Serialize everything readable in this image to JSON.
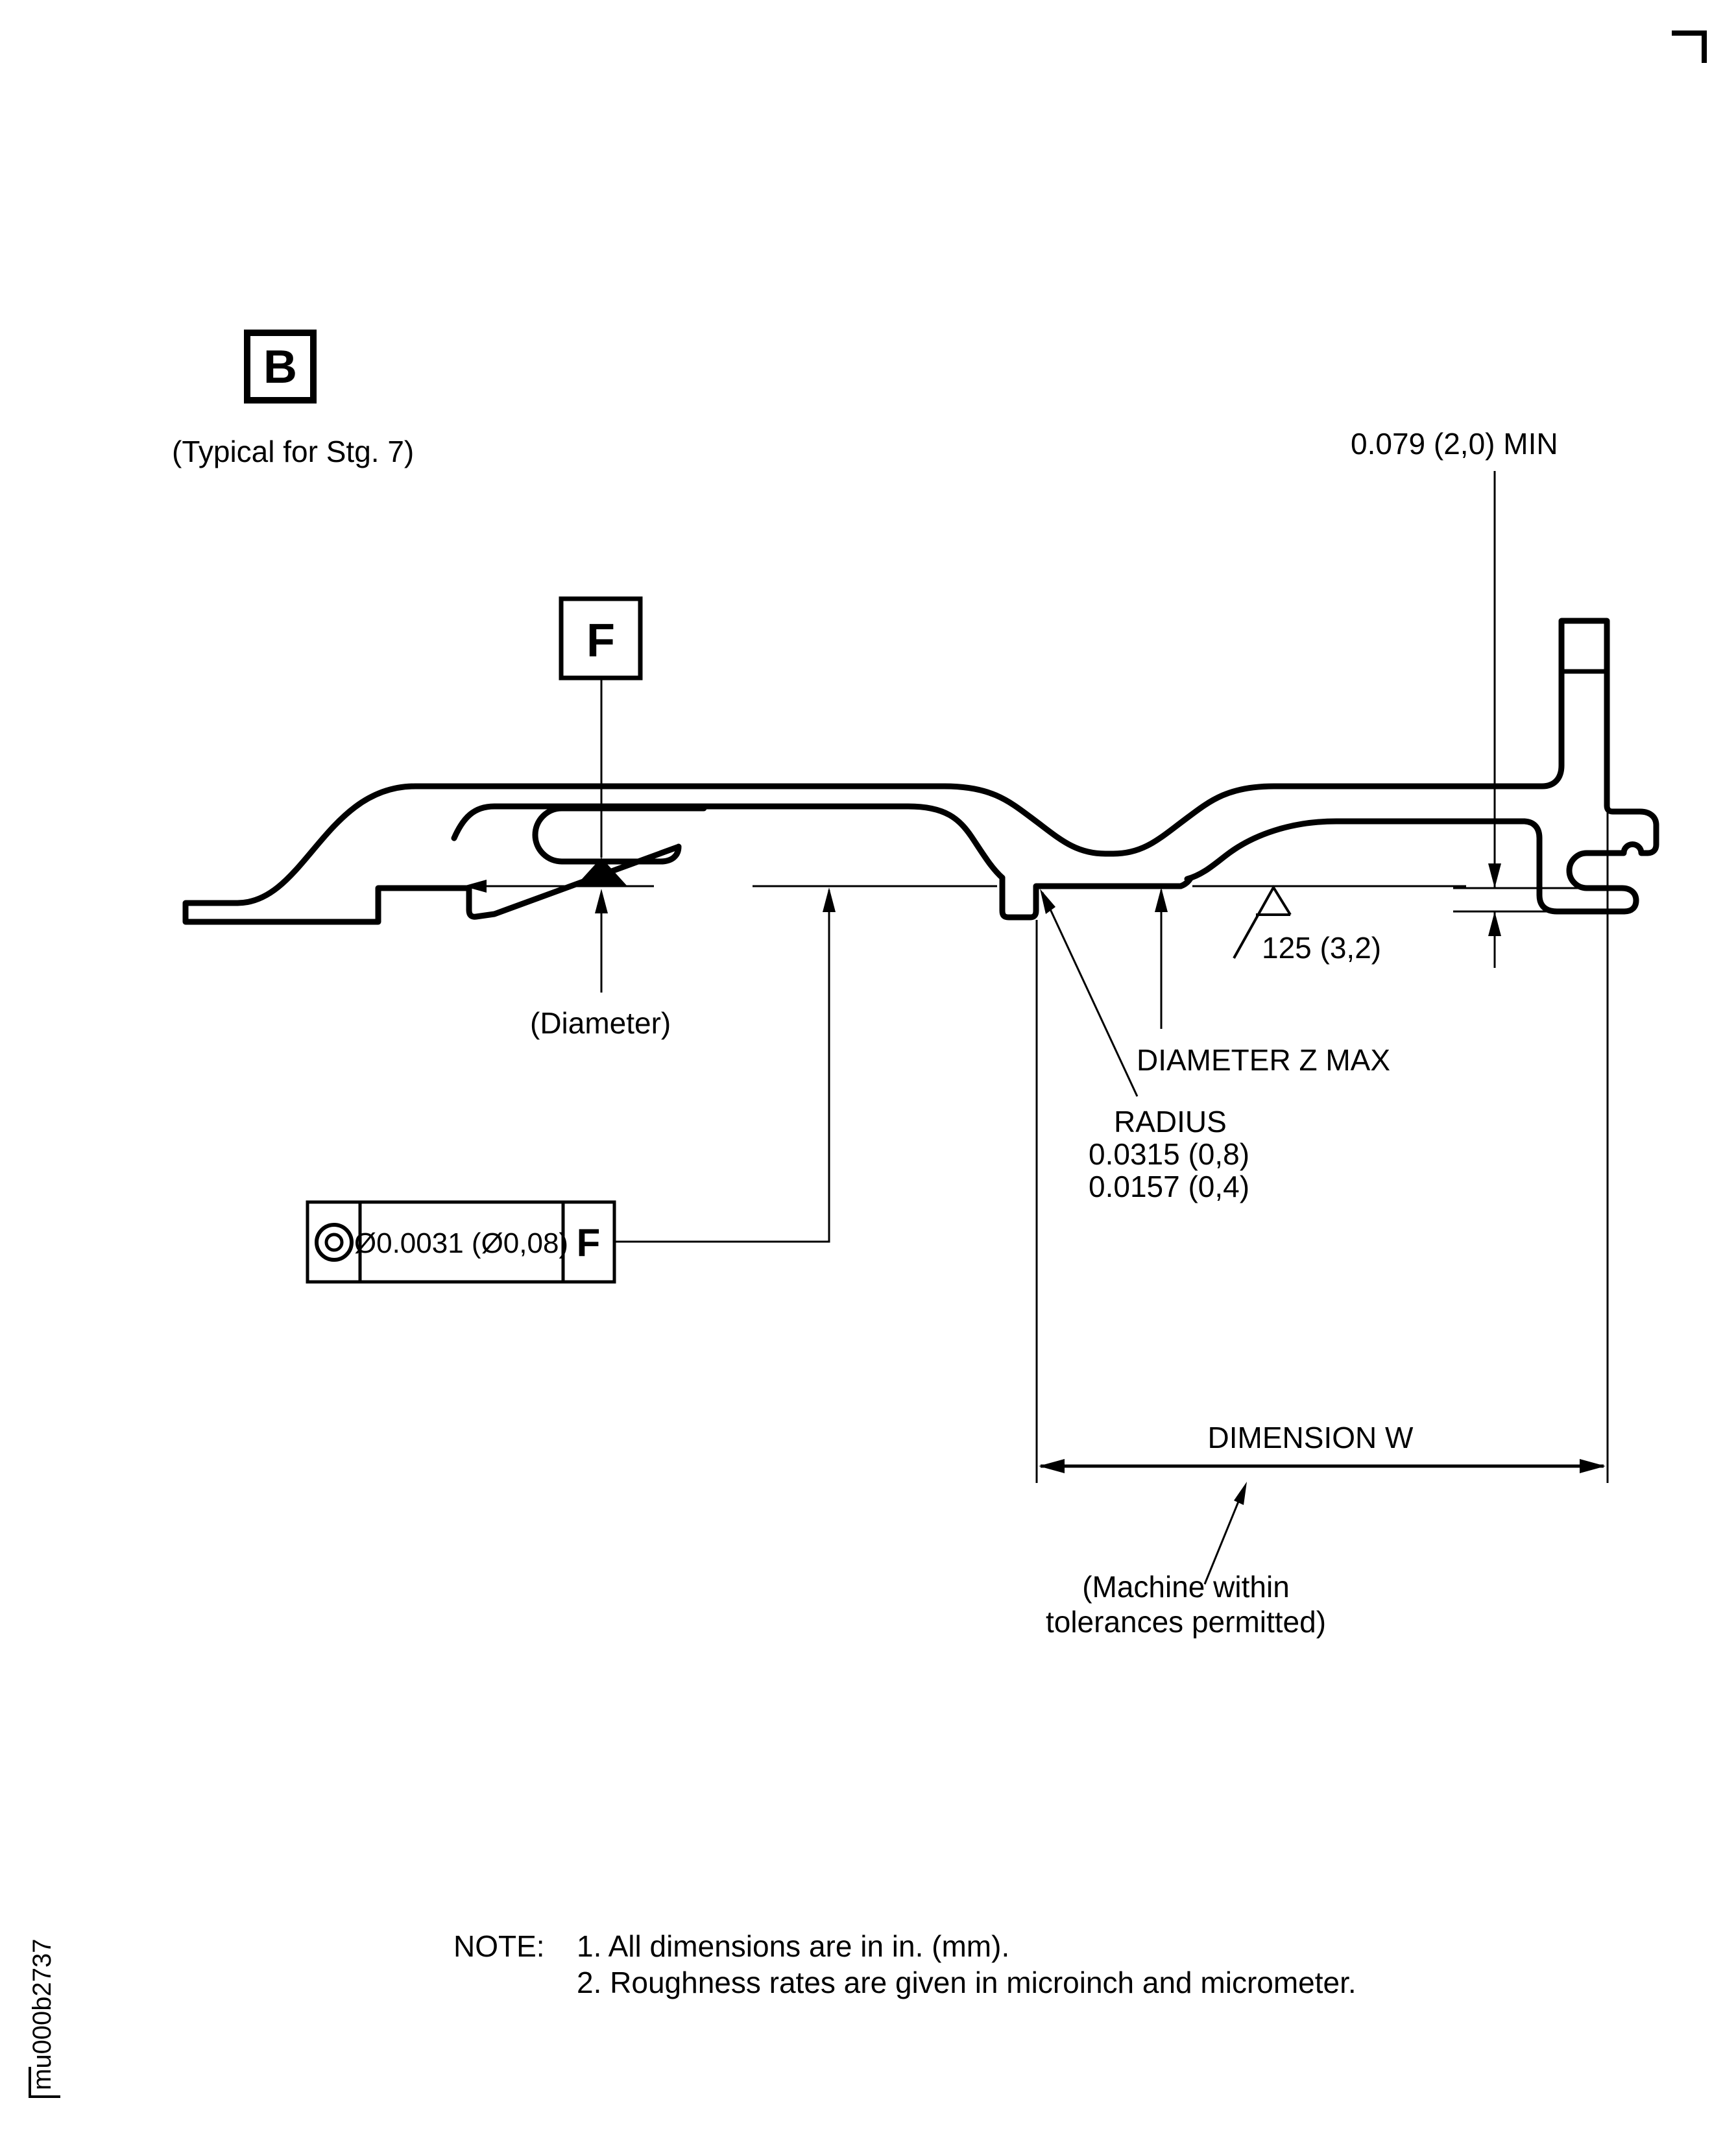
{
  "drawing": {
    "title_block": {
      "doc_id": "mu000b2737"
    },
    "datums": {
      "b_label": "B",
      "b_note": "(Typical for Stg. 7)",
      "f_label": "F"
    },
    "annotations": {
      "min_wall": "0.079 (2,0) MIN",
      "diameter_note": "(Diameter)",
      "roughness": "125 (3,2)",
      "diameter_z": "DIAMETER Z MAX",
      "radius_label": "RADIUS",
      "radius_value_1": "0.0315 (0,8)",
      "radius_value_2": "0.0157 (0,4)",
      "dimension_w": "DIMENSION W",
      "machine_note_line1": "(Machine within",
      "machine_note_line2": "tolerances permitted)"
    },
    "feature_control_frame": {
      "symbol_name": "concentricity",
      "tolerance": "Ø0.0031 (Ø0,08)",
      "datum_ref": "F"
    },
    "notes": {
      "label": "NOTE:",
      "note_1": "1. All dimensions are in in. (mm).",
      "note_2": "2. Roughness rates are given in microinch and micrometer."
    },
    "colors": {
      "line": "#000000",
      "background": "#ffffff"
    }
  }
}
